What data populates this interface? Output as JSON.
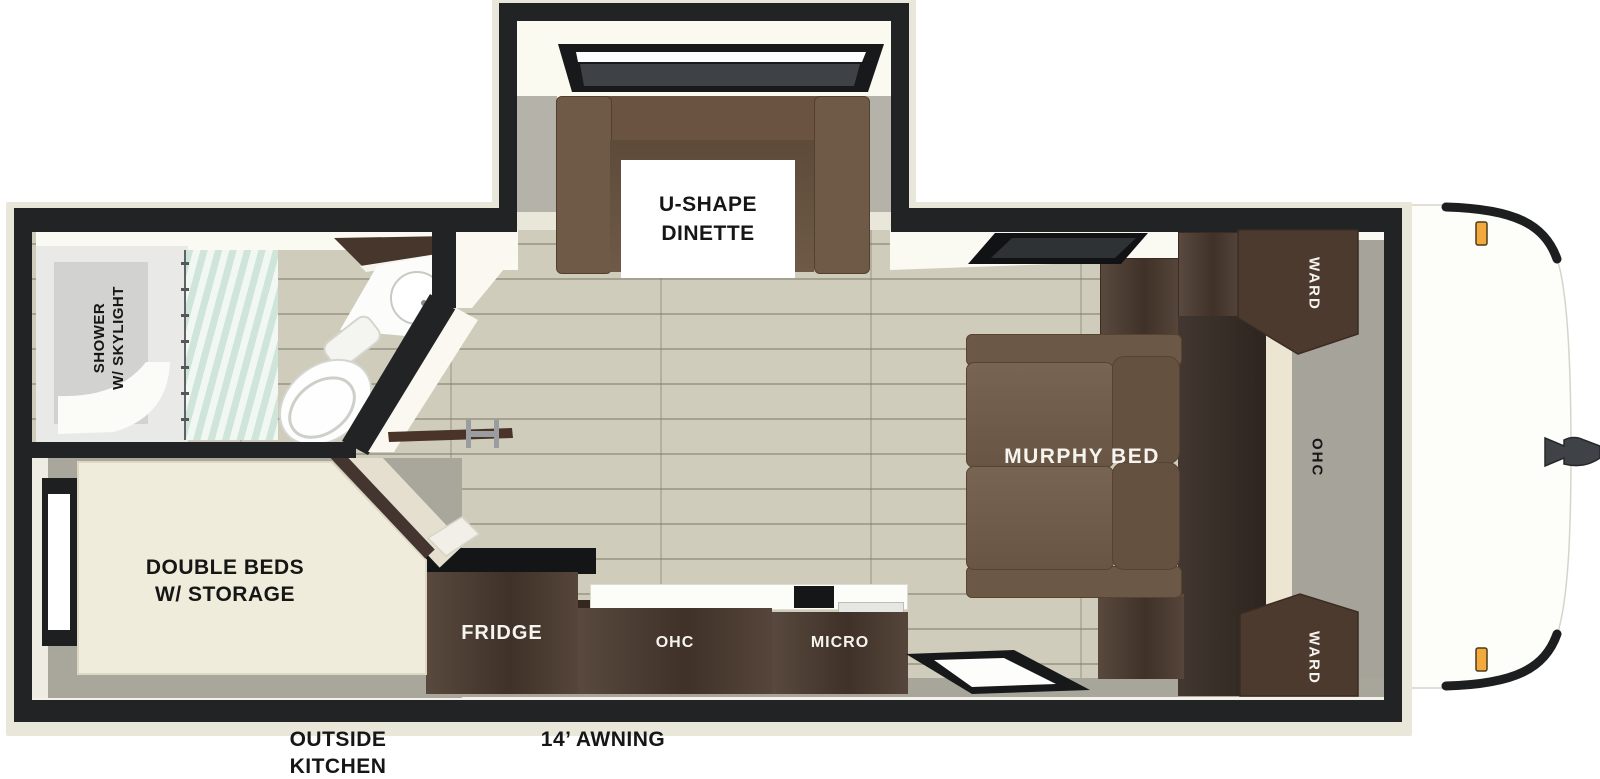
{
  "title": "Travel trailer floor plan",
  "labels": {
    "dinette_line1": "U-SHAPE",
    "dinette_line2": "DINETTE",
    "shower_line1": "SHOWER",
    "shower_line2": "W/ SKYLIGHT",
    "double_beds_line1": "DOUBLE BEDS",
    "double_beds_line2": "W/ STORAGE",
    "murphy_bed": "MURPHY BED",
    "fridge": "FRIDGE",
    "kitchen_ohc": "OHC",
    "micro": "MICRO",
    "ward_top": "WARD",
    "ward_bottom": "WARD",
    "front_ohc": "OHC",
    "outside_kitchen_line1": "OUTSIDE",
    "outside_kitchen_line2": "KITCHEN",
    "awning": "14’ AWNING"
  },
  "colors": {
    "wall_black": "#212325",
    "outer_trim": "#e9e6da",
    "interior_white": "#fbfaf2",
    "floor_wood": "#cfccbb",
    "floor_gray": "#a8a59b",
    "cabinet_brown": "#4c3b30",
    "sofa_brown": "#6d5947",
    "bed_cream": "#f0ecdb",
    "curtain_mint": "#d9eae2",
    "marker_light_amber": "#f3a93c"
  }
}
